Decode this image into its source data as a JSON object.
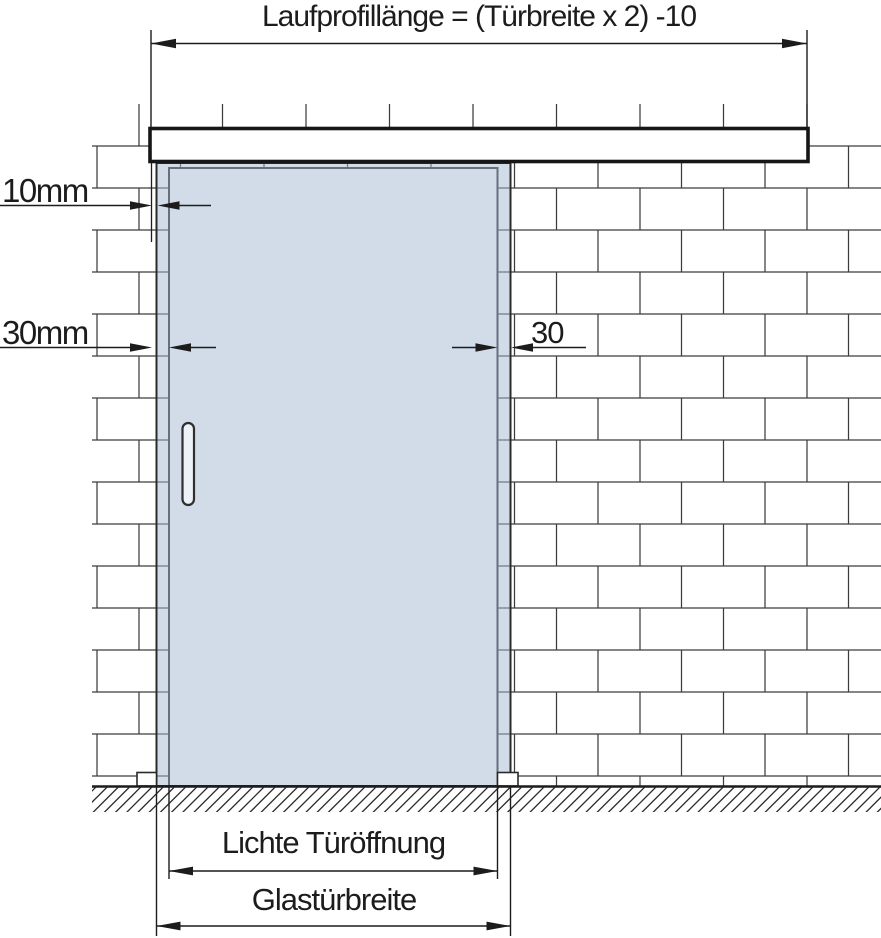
{
  "diagram": {
    "top_dimension": {
      "label": "Laufprofillänge = (Türbreite x 2) -10"
    },
    "left_dimensions": {
      "top_offset": {
        "label": "10mm"
      },
      "side_overlap": {
        "label": "30mm"
      }
    },
    "right_dimension": {
      "side_overlap": {
        "label": "30"
      }
    },
    "bottom_dimensions": {
      "clear_opening": {
        "label": "Lichte Türöffnung"
      },
      "glass_door_width": {
        "label": "Glastürbreite"
      }
    },
    "colors": {
      "glass_fill": "#d9e2ec",
      "dimension_line": "#1c1c1c",
      "brick_line": "#3c3c3c",
      "background": "#ffffff"
    }
  }
}
